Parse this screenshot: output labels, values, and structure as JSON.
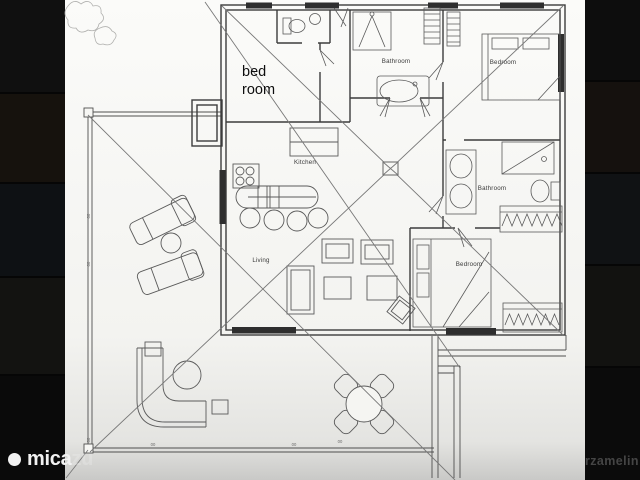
{
  "viewer": {
    "background_color": "#060606"
  },
  "plan": {
    "paper_color": "#f7f7f4",
    "line_color": "#4a4a4a",
    "annotation": {
      "line1": "bed",
      "line2": "room"
    },
    "rooms": {
      "bathroom_top": "Bathroom",
      "bedroom_top_right": "Bedroom",
      "kitchen": "Kitchen",
      "bathroom_right": "Bathroom",
      "living": "Living",
      "bedroom_bottom_right": "Bedroom"
    },
    "dimension_tick": "00"
  },
  "watermark": {
    "brand_visible": "mica",
    "brand_faded": "zu",
    "right_text": "rzamelin",
    "brand_color": "#f2f2f2",
    "right_text_color": "#454545"
  }
}
